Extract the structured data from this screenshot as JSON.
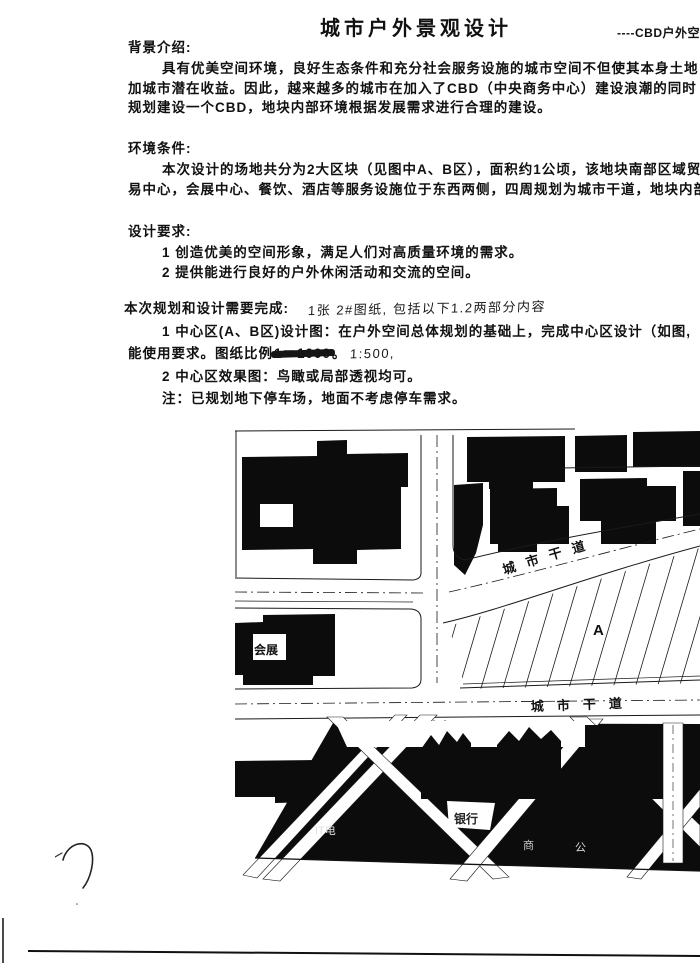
{
  "header": {
    "title": "城市户外景观设计",
    "corner_note": "----CBD户外空间"
  },
  "background": {
    "heading": "背景介绍:",
    "line1": "具有优美空间环境，良好生态条件和充分社会服务设施的城市空间不但使其本身土地",
    "line2": "加城市潜在收益。因此，越来越多的城市在加入了CBD（中央商务中心）建设浪潮的同时",
    "line3": "规划建设一个CBD，地块内部环境根据发展需求进行合理的建设。"
  },
  "environment": {
    "heading": "环境条件:",
    "line1": "本次设计的场地共分为2大区块（见图中A、B区），面积约1公顷，该地块南部区域贸",
    "line2": "易中心，会展中心、餐饮、酒店等服务设施位于东西两侧，四周规划为城市干道，地块内部"
  },
  "design_requirements": {
    "heading": "设计要求:",
    "item1": "1 创造优美的空间形象，满足人们对高质量环境的需求。",
    "item2": "2 提供能进行良好的户外休闲活动和交流的空间。"
  },
  "tasks": {
    "heading": "本次规划和设计需要完成:",
    "handwritten_note": "1张 2#图纸, 包括以下1.2两部分内容",
    "item1_line1": "1 中心区(A、B区)设计图：在户外空间总体规划的基础上，完成中心区设计（如图,",
    "item1_line2_prefix": "能使用要求。图纸比例",
    "item1_line2_struck": "1＝1000",
    "item1_line2_after": "。",
    "item1_line2_handwritten": "1:500,",
    "item2": "2 中心区效果图：鸟瞰或局部透视均可。",
    "note": "注：已规划地下停车场，地面不考虑停车需求。"
  },
  "map": {
    "labels": {
      "road_upper": "城市干道",
      "road_lower": "城市干道",
      "zone_a": "A",
      "exhibition_building": "会展",
      "bank": "银行",
      "utility": "IT电",
      "right_label_1": "商",
      "right_label_2": "公"
    }
  }
}
